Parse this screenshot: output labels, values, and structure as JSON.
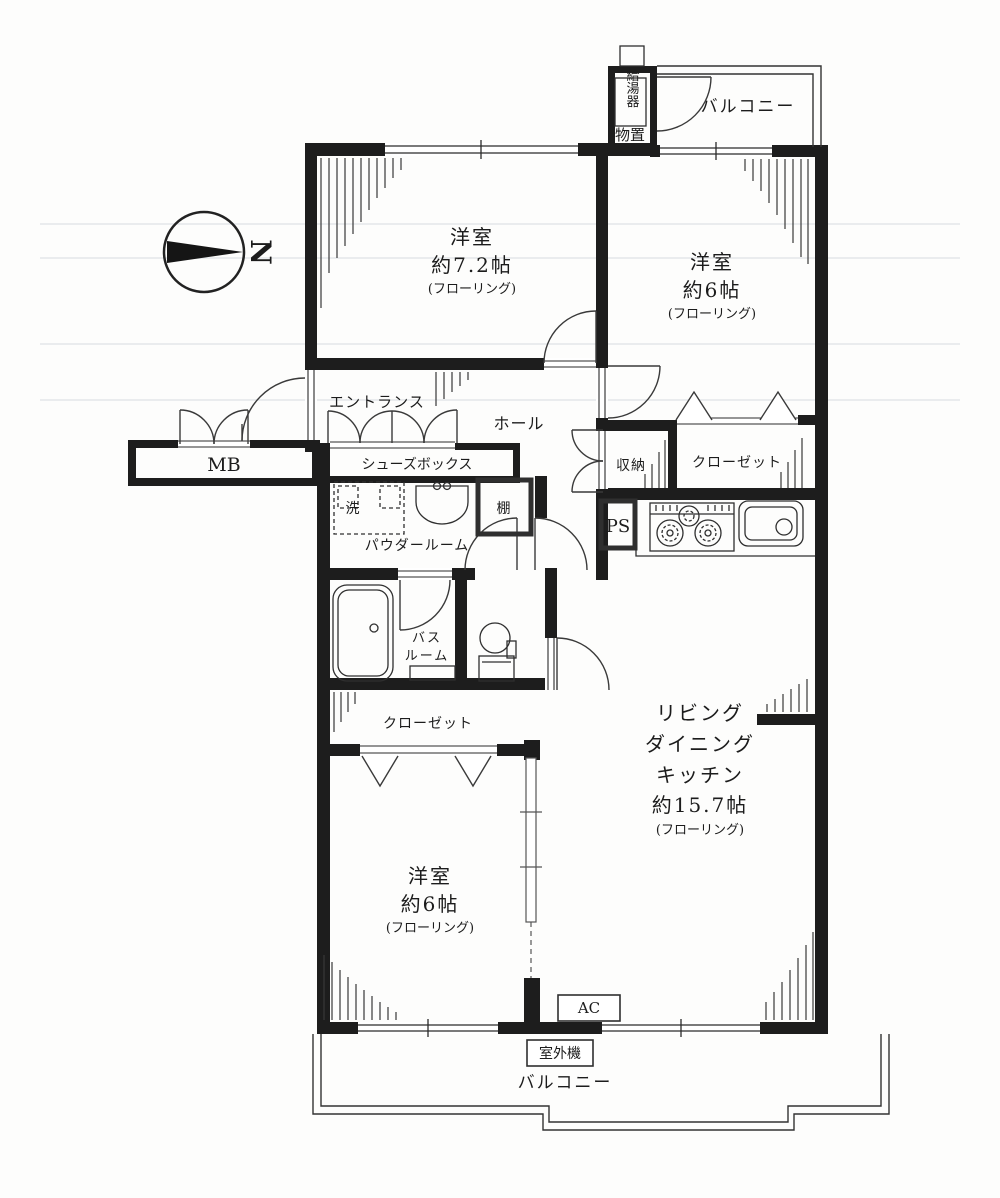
{
  "compass": {
    "north_label": "N"
  },
  "rooms": {
    "bedroom_main": {
      "name": "洋室",
      "size": "約7.2帖",
      "floor_note": "(フローリング)"
    },
    "bedroom_upper": {
      "name": "洋室",
      "size": "約6帖",
      "floor_note": "(フローリング)"
    },
    "bedroom_lower": {
      "name": "洋室",
      "size": "約6帖",
      "floor_note": "(フローリング)"
    },
    "ldk": {
      "line1": "リビング",
      "line2": "ダイニング",
      "line3": "キッチン",
      "size": "約15.7帖",
      "floor_note": "(フローリング)"
    },
    "entrance": {
      "name": "エントランス"
    },
    "hall": {
      "name": "ホール"
    },
    "powder_room": {
      "name": "パウダールーム"
    },
    "bathroom": {
      "line1": "バス",
      "line2": "ルーム"
    },
    "balcony_upper": {
      "name": "バルコニー"
    },
    "balcony_lower": {
      "name": "バルコニー"
    }
  },
  "storage": {
    "mono_oki": {
      "name": "物置"
    },
    "water_heater": {
      "name": "給湯器"
    },
    "shuno": {
      "name": "収納"
    },
    "closet_upper": {
      "name": "クローゼット"
    },
    "closet_lower": {
      "name": "クローゼット"
    },
    "shoes_box": {
      "name": "シューズボックス"
    },
    "shelf": {
      "name": "棚"
    },
    "mb": {
      "name": "MB"
    },
    "ps": {
      "name": "PS"
    }
  },
  "fixtures": {
    "washer": {
      "name": "洗"
    },
    "ac": {
      "name": "AC"
    },
    "outdoor_unit": {
      "name": "室外機"
    }
  },
  "colors": {
    "wall": "#1d1d1d",
    "line": "#3a3a3a"
  }
}
